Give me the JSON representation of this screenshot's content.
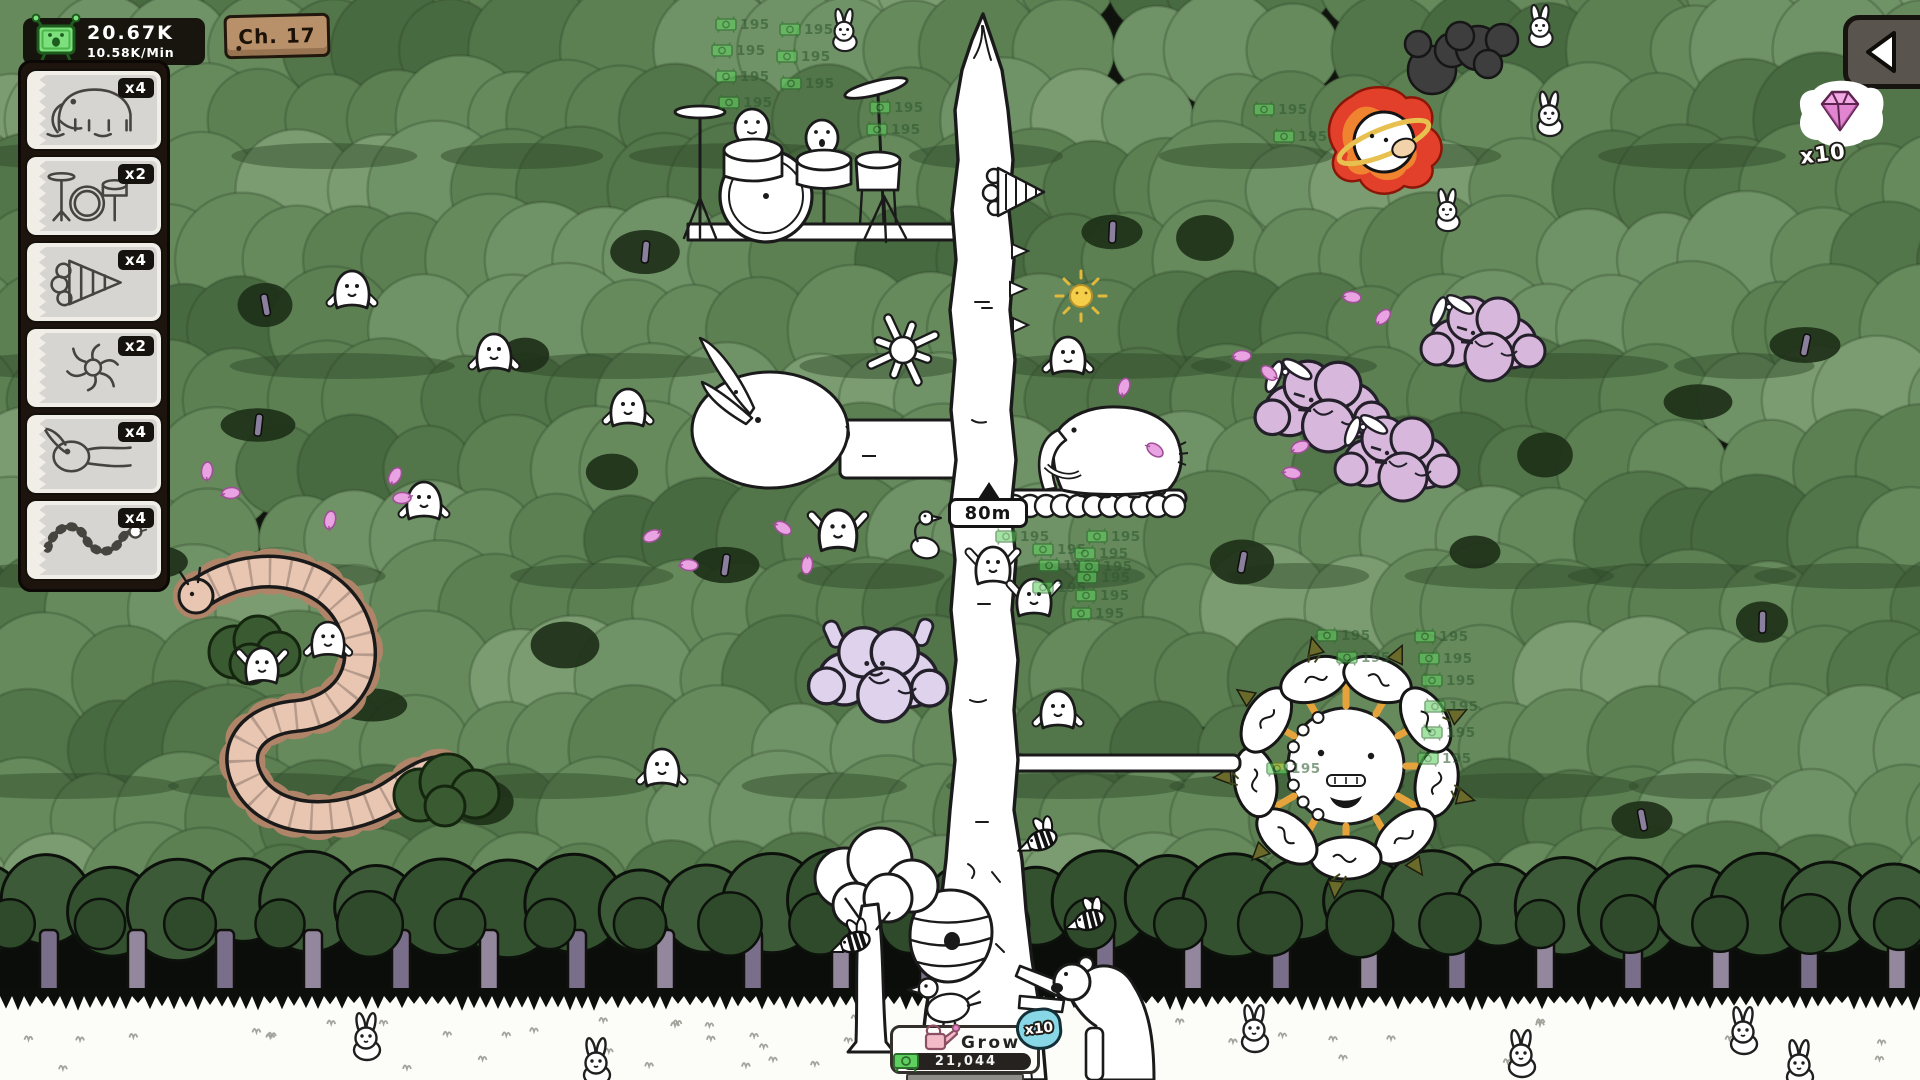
{
  "hud": {
    "money": {
      "value": "20.67K",
      "rate": "10.58K/Min"
    },
    "chapter": "Ch. 17",
    "gem_count": "x10",
    "height_marker": "80m",
    "grow": {
      "label": "Grow",
      "progress": "21,044",
      "water_multiplier": "x10"
    }
  },
  "cards": [
    {
      "creature": "mammoth",
      "multiplier": "x4"
    },
    {
      "creature": "drum-kit",
      "multiplier": "x2"
    },
    {
      "creature": "drill",
      "multiplier": "x4"
    },
    {
      "creature": "splat",
      "multiplier": "x2"
    },
    {
      "creature": "goose",
      "multiplier": "x4"
    },
    {
      "creature": "worm",
      "multiplier": "x4"
    }
  ],
  "popups": {
    "value": "195",
    "positions": [
      [
        715,
        16
      ],
      [
        711,
        42
      ],
      [
        715,
        68
      ],
      [
        718,
        94
      ],
      [
        779,
        21
      ],
      [
        776,
        48
      ],
      [
        780,
        75
      ],
      [
        869,
        99
      ],
      [
        866,
        121
      ],
      [
        1253,
        101
      ],
      [
        1273,
        128
      ],
      [
        995,
        528
      ],
      [
        1086,
        528
      ],
      [
        1032,
        541
      ],
      [
        1074,
        545
      ],
      [
        1038,
        557
      ],
      [
        1078,
        558
      ],
      [
        1076,
        569
      ],
      [
        1032,
        579
      ],
      [
        1075,
        587
      ],
      [
        1070,
        605
      ],
      [
        1414,
        628
      ],
      [
        1418,
        650
      ],
      [
        1421,
        672
      ],
      [
        1424,
        698
      ],
      [
        1421,
        724
      ],
      [
        1417,
        750
      ],
      [
        1316,
        627
      ],
      [
        1336,
        649
      ],
      [
        1266,
        760
      ]
    ]
  },
  "colors": {
    "hud_bg": "#100c08",
    "money_green": "#7ce07c",
    "gem_pink": "#f2aae4",
    "water_blue": "#88d7e6",
    "popup_green": "#2e5930",
    "canopy_base": "#6f9266"
  }
}
